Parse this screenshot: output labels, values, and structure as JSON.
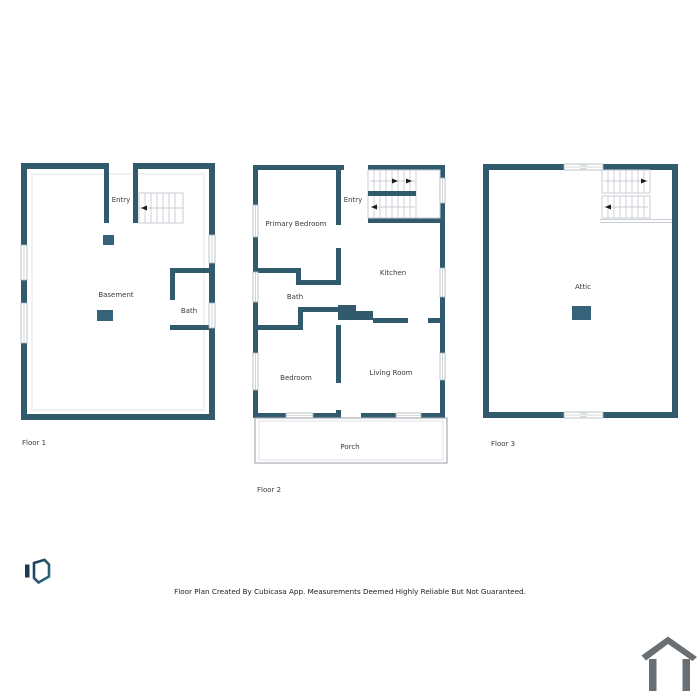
{
  "floor1": {
    "label": "Floor 1",
    "rooms": {
      "basement": "Basement",
      "entry": "Entry",
      "bath": "Bath"
    }
  },
  "floor2": {
    "label": "Floor 2",
    "rooms": {
      "primary_bedroom": "Primary Bedroom",
      "entry": "Entry",
      "kitchen": "Kitchen",
      "bath": "Bath",
      "bedroom": "Bedroom",
      "living_room": "Living Room",
      "porch": "Porch"
    }
  },
  "floor3": {
    "label": "Floor 3",
    "rooms": {
      "attic": "Attic"
    }
  },
  "footer": {
    "disclaimer": "Floor Plan Created By Cubicasa App. Measurements Deemed Highly Reliable But Not Guaranteed."
  },
  "icons": {
    "logo": "cubicasa-logo",
    "house": "house-outline-icon",
    "stair_direction": "stair-arrow-icon"
  },
  "colors": {
    "wall": "#315a6d",
    "furniture": "#366379",
    "stair_line": "#c8ced3",
    "window_border": "#adb7bd",
    "porch_line": "#a6adb3",
    "porch_inner": "#d4d9dc",
    "inset_line": "#e1e5e8",
    "label_text": "#3a3a3a",
    "arrow": "#1a1a1a",
    "logo_navy": "#1d3a56",
    "logo_teal": "#2e6e80",
    "house_icon": "#6a6f73"
  }
}
